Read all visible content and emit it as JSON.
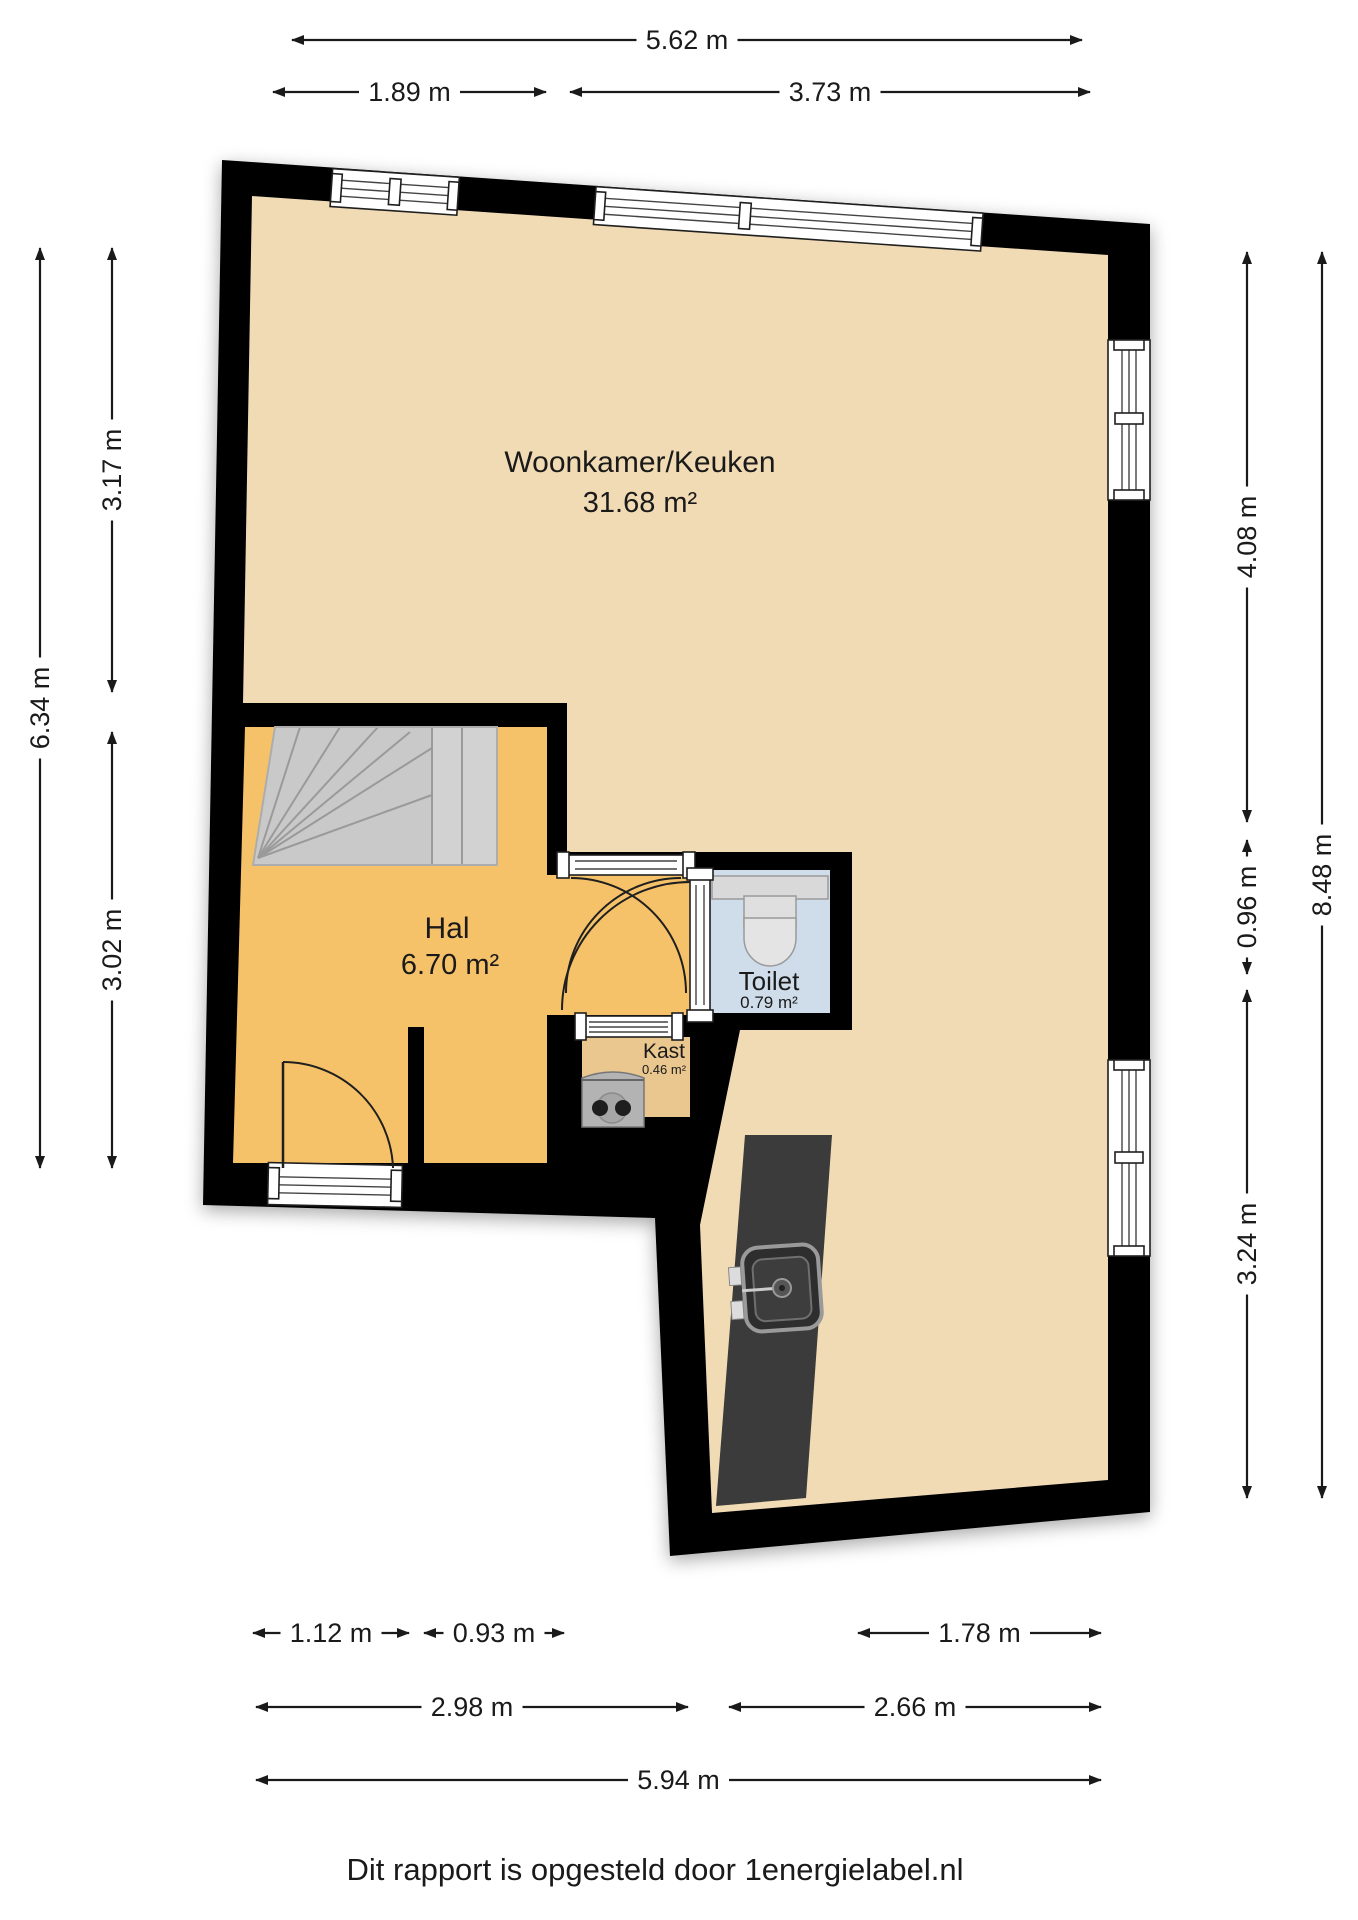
{
  "footer": {
    "credit": "Dit rapport is opgesteld door 1energielabel.nl"
  },
  "rooms": [
    {
      "name": "Woonkamer/Keuken",
      "area": "31.68 m²"
    },
    {
      "name": "Hal",
      "area": "6.70 m²"
    },
    {
      "name": "Toilet",
      "area": "0.79 m²"
    },
    {
      "name": "Kast",
      "area": "0.46 m²"
    }
  ],
  "colors": {
    "wall": "#000000",
    "floor_main": "#F1DBB4",
    "floor_hall": "#F6C269",
    "floor_toilet": "#CFDDEB",
    "floor_kast": "#E9C78F",
    "stairs": "#C9C9C9",
    "counter": "#3B3B3B",
    "fixture_gray": "#B3B3B3",
    "dim_line": "#1a1a1a"
  },
  "dimensions": [
    {
      "label": "5.62 m",
      "x1": 292,
      "y1": 40,
      "x2": 1082,
      "y2": 40
    },
    {
      "label": "1.89 m",
      "x1": 273,
      "y1": 92,
      "x2": 546,
      "y2": 92
    },
    {
      "label": "3.73 m",
      "x1": 570,
      "y1": 92,
      "x2": 1090,
      "y2": 92
    },
    {
      "label": "6.34 m",
      "x1": 40,
      "y1": 248,
      "x2": 40,
      "y2": 1168
    },
    {
      "label": "3.17 m",
      "x1": 112,
      "y1": 248,
      "x2": 112,
      "y2": 692
    },
    {
      "label": "3.02 m",
      "x1": 112,
      "y1": 732,
      "x2": 112,
      "y2": 1168
    },
    {
      "label": "4.08 m",
      "x1": 1247,
      "y1": 252,
      "x2": 1247,
      "y2": 822
    },
    {
      "label": "0.96 m",
      "x1": 1247,
      "y1": 840,
      "x2": 1247,
      "y2": 974
    },
    {
      "label": "3.24 m",
      "x1": 1247,
      "y1": 990,
      "x2": 1247,
      "y2": 1498
    },
    {
      "label": "8.48 m",
      "x1": 1322,
      "y1": 252,
      "x2": 1322,
      "y2": 1498
    },
    {
      "label": "1.12 m",
      "x1": 253,
      "y1": 1633,
      "x2": 409,
      "y2": 1633
    },
    {
      "label": "0.93 m",
      "x1": 424,
      "y1": 1633,
      "x2": 564,
      "y2": 1633
    },
    {
      "label": "1.78 m",
      "x1": 858,
      "y1": 1633,
      "x2": 1101,
      "y2": 1633
    },
    {
      "label": "2.98 m",
      "x1": 256,
      "y1": 1707,
      "x2": 688,
      "y2": 1707
    },
    {
      "label": "2.66 m",
      "x1": 729,
      "y1": 1707,
      "x2": 1101,
      "y2": 1707
    },
    {
      "label": "5.94 m",
      "x1": 256,
      "y1": 1780,
      "x2": 1101,
      "y2": 1780
    }
  ]
}
